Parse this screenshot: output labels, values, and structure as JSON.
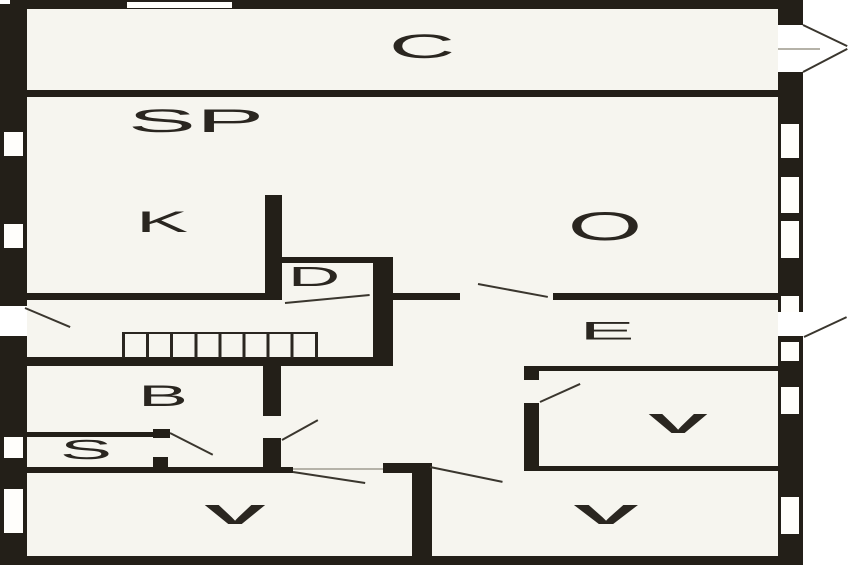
{
  "plan": {
    "type": "apartment floor plan",
    "rooms": [
      {
        "id": "c",
        "label": "C"
      },
      {
        "id": "sp",
        "label": "SP"
      },
      {
        "id": "k",
        "label": "K"
      },
      {
        "id": "o",
        "label": "O"
      },
      {
        "id": "d",
        "label": "D"
      },
      {
        "id": "e",
        "label": "E"
      },
      {
        "id": "b",
        "label": "B"
      },
      {
        "id": "s",
        "label": "S"
      },
      {
        "id": "v_middle_right",
        "label": "V"
      },
      {
        "id": "v_bottom_left",
        "label": "V"
      },
      {
        "id": "v_bottom_right",
        "label": "V"
      }
    ],
    "staircase": {
      "location": "central corridor",
      "treads": 8
    },
    "entrance": {
      "symbol": "arrow",
      "direction": "right",
      "location": "top-right wall"
    },
    "windows": {
      "left_wall": 4,
      "right_wall": 7,
      "top_wall": 1
    },
    "door_swings": 9,
    "colors": {
      "wall": "#231f18",
      "floor": "#f6f5ef",
      "outside": "#ffffff",
      "swing_line": "#3a362e"
    }
  }
}
